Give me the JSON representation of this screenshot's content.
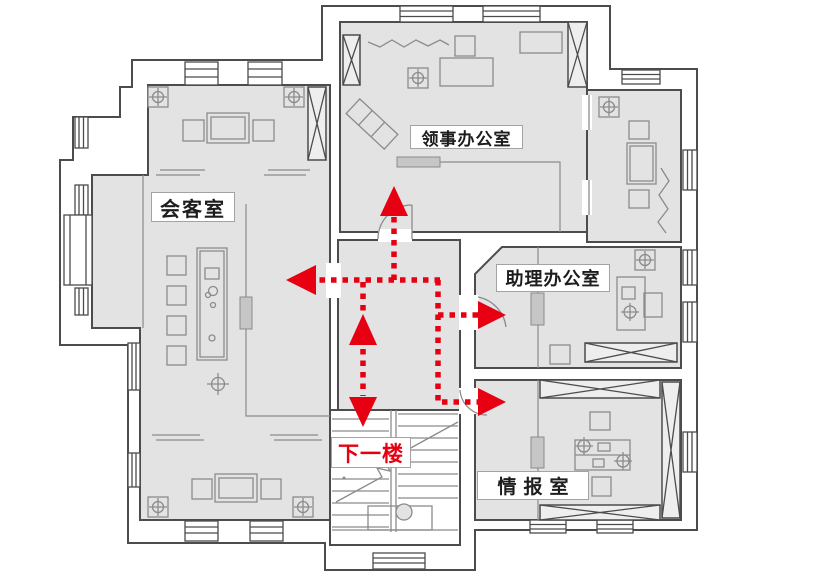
{
  "canvas": {
    "width": 835,
    "height": 581
  },
  "colors": {
    "background": "#ffffff",
    "floor": "#e3e3e4",
    "wall": "#4c4c4d",
    "furniture": "#8b8b8b",
    "door_fill": "#c6c6c7",
    "route": "#e60012",
    "label_border": "#a3a3a3",
    "label_bg": "#ffffff",
    "label_text": "#1d1d1d"
  },
  "rooms": [
    {
      "id": "reception-room",
      "label": "会客室"
    },
    {
      "id": "consul-office",
      "label": "领事办公室"
    },
    {
      "id": "assistant-office",
      "label": "助理办公室"
    },
    {
      "id": "intelligence-room",
      "label": "情报室"
    }
  ],
  "stairs": {
    "label": "下一楼",
    "label_color": "#e60012"
  },
  "route": {
    "color": "#e60012",
    "style": "dotted-arrows",
    "arrows": [
      {
        "id": "up-to-consul-office",
        "direction": "up"
      },
      {
        "id": "left-to-reception-room",
        "direction": "left"
      },
      {
        "id": "up-from-stairs",
        "direction": "up"
      },
      {
        "id": "down-to-stairs",
        "direction": "down"
      },
      {
        "id": "right-to-assistant-office",
        "direction": "right"
      },
      {
        "id": "right-to-intelligence-room",
        "direction": "right"
      }
    ]
  }
}
